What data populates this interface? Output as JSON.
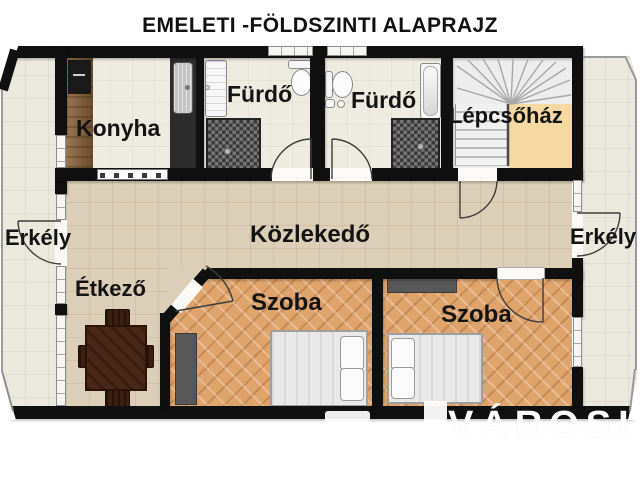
{
  "title": "EMELETI -FÖLDSZINTI ALAPRAJZ",
  "watermark": {
    "name": "VÁROSI"
  },
  "rooms": {
    "konyha": "Konyha",
    "furdo1": "Fürdő",
    "furdo2": "Fürdő",
    "lepcsohaz": "Lépcsőház",
    "kozlekedo": "Közlekedő",
    "erkely_left": "Erkély",
    "erkely_right": "Erkély",
    "etkezo": "Étkező",
    "szoba1": "Szoba",
    "szoba2": "Szoba"
  },
  "colors": {
    "wall": "#101010",
    "hall_floor": "#dccfb8",
    "room_floor": "#dfa46c",
    "bath_floor": "#eeebe1",
    "balcony_floor": "#ebe8de",
    "stair_landing": "#f6d9a2",
    "counter_wood": "#8a6a48"
  }
}
